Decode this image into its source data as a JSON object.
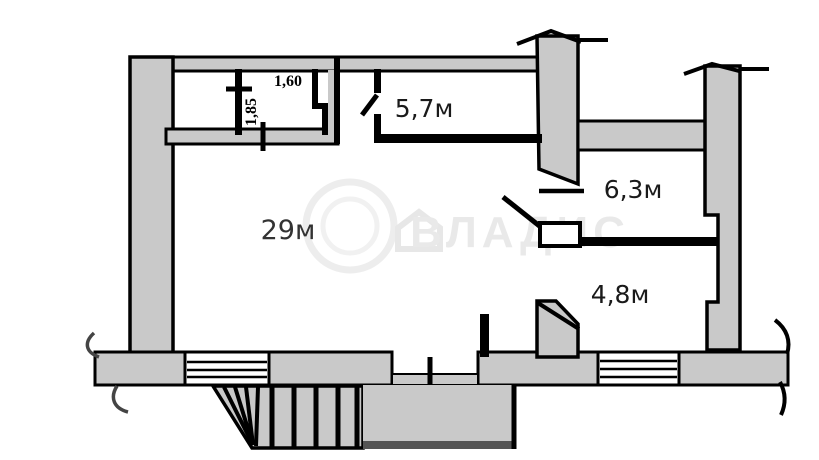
{
  "plan": {
    "type": "apartment-floor-plan",
    "rooms": {
      "room_29": {
        "label": "29м"
      },
      "room_57": {
        "label": "5,7м"
      },
      "room_63": {
        "label": "6,3м"
      },
      "room_48": {
        "label": "4,8м"
      }
    },
    "dimensions": {
      "closet_width": "1,60",
      "closet_depth": "1,85"
    },
    "watermark": {
      "text": "ВЛАДИС"
    }
  },
  "colors": {
    "background": "#ffffff",
    "wall_fill": "#c9c9c9",
    "line": "#000000",
    "porch_edge": "#555555",
    "watermark": "#e9e9e9"
  }
}
